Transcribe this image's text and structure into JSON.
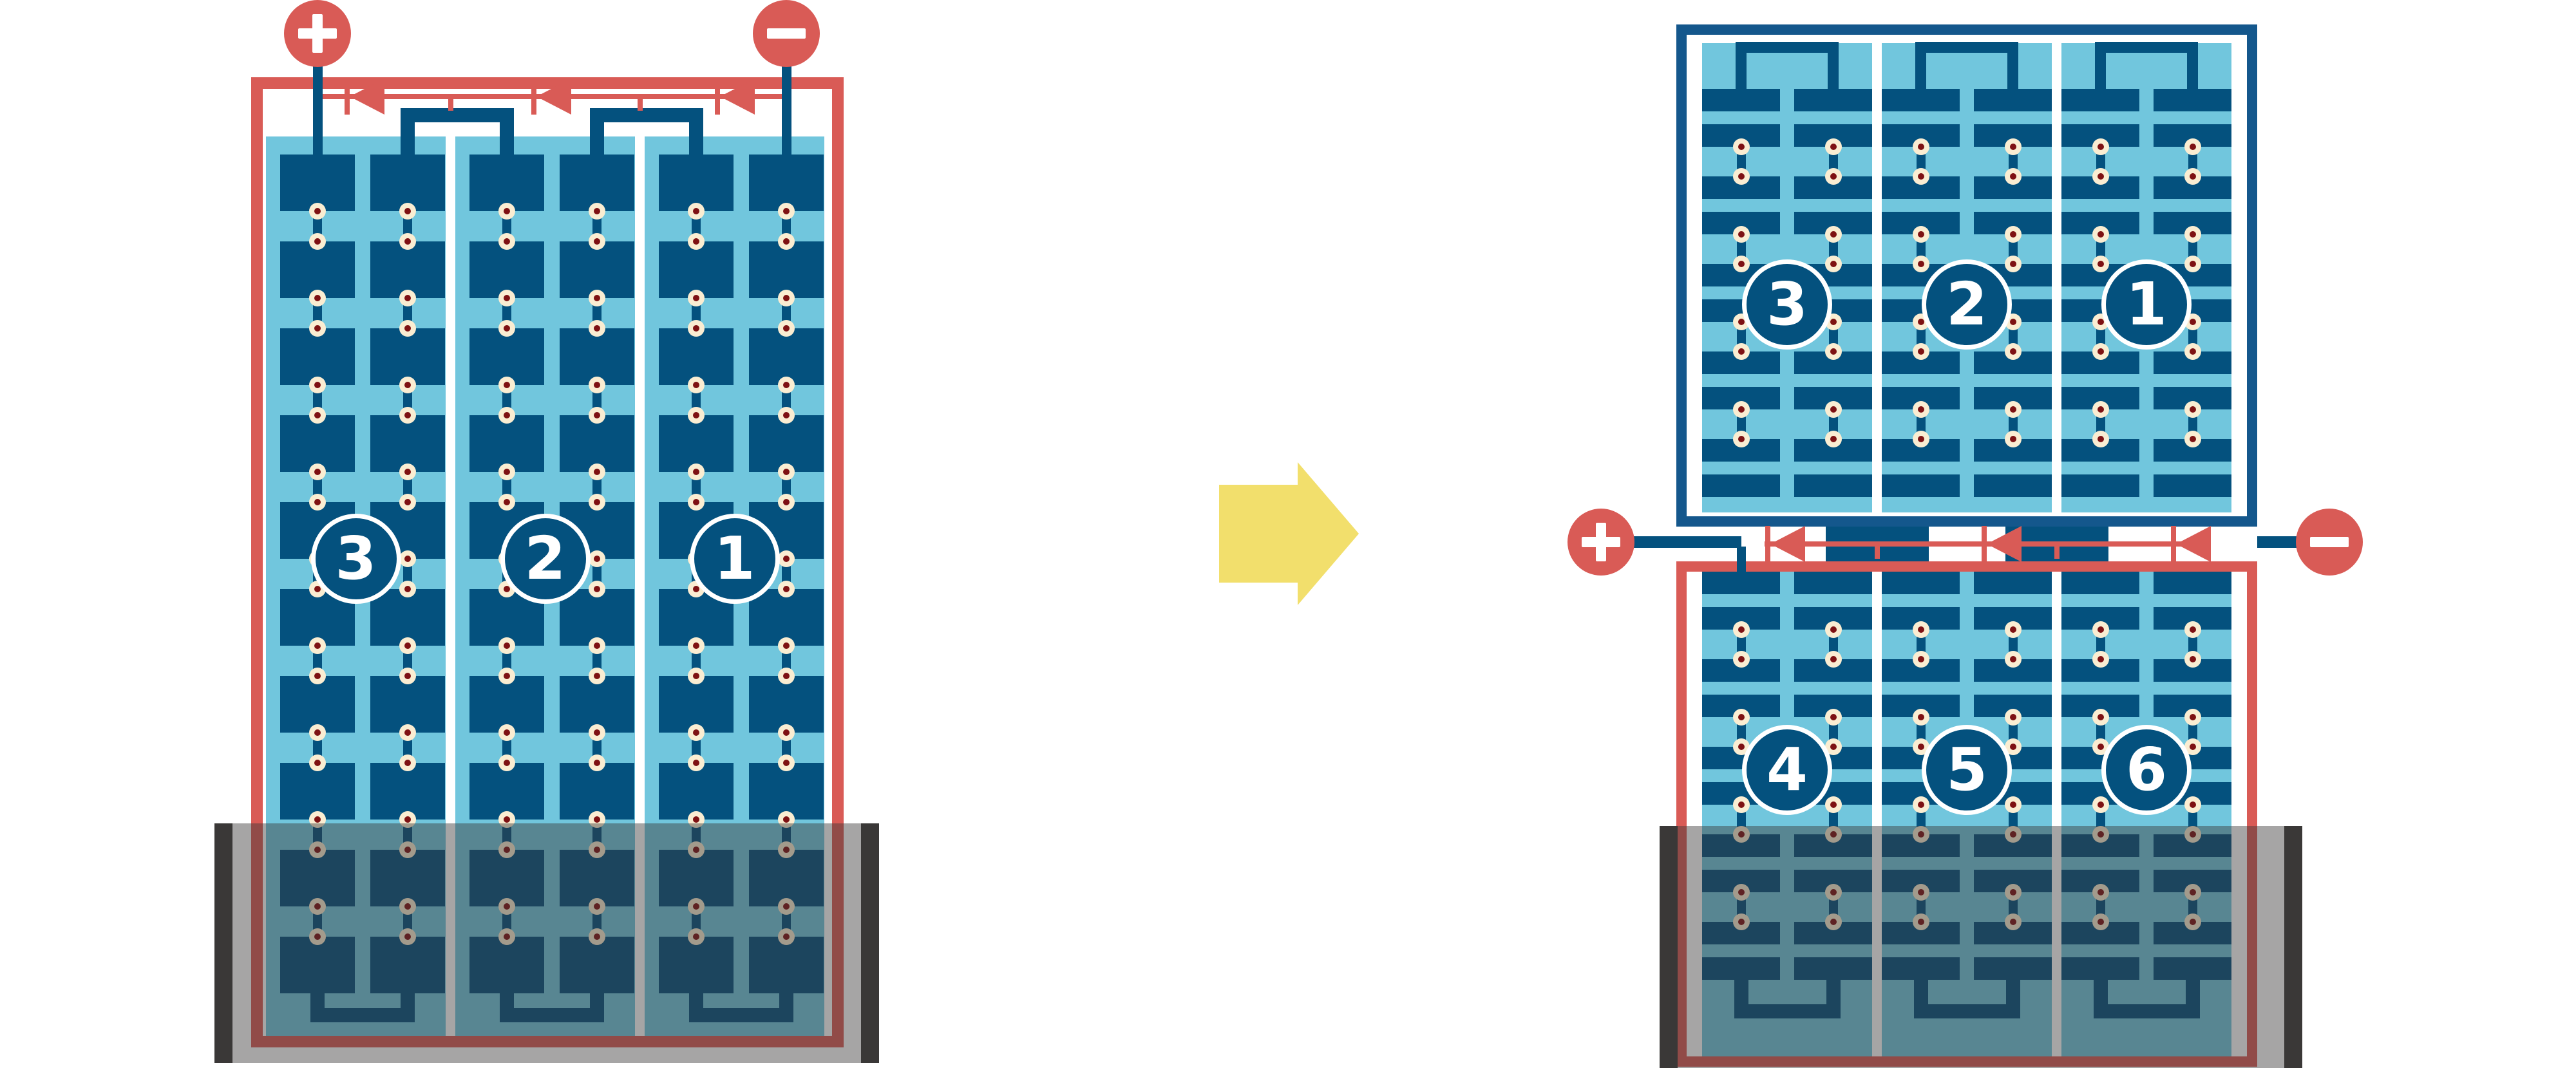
{
  "diagram_kind": "solar-module-string-wiring-comparison",
  "colors": {
    "cell_blue": "#04517E",
    "panel_light_blue": "#71C6DD",
    "frame_red": "#D95B56",
    "frame_blue": "#14578C",
    "circuit_red": "#D95B56",
    "solder_dot_cream": "#FAEDD2",
    "solder_dot_red": "#7E1113",
    "shade_bar_gray": "#3A3837",
    "shade_overlay": "rgba(58,56,55,0.45)",
    "arrow_yellow": "#F2DF6C",
    "separator_white": "#FFFFFF",
    "label_text": "#FFFFFF"
  },
  "left_module": {
    "kind": "full-cell module",
    "terminals": {
      "positive_symbol": "+",
      "negative_symbol": "−"
    },
    "bypass_diode_count": 3,
    "strings": [
      {
        "label": "3"
      },
      {
        "label": "2"
      },
      {
        "label": "1"
      }
    ],
    "columns_per_string": 2,
    "cell_rows": 10,
    "shaded_bottom": true
  },
  "right_module": {
    "kind": "half-cell module",
    "terminals": {
      "positive_symbol": "+",
      "negative_symbol": "−"
    },
    "bypass_diode_count": 3,
    "top_half": {
      "strings": [
        {
          "label": "3"
        },
        {
          "label": "2"
        },
        {
          "label": "1"
        }
      ],
      "cell_rows": 10
    },
    "bottom_half": {
      "strings": [
        {
          "label": "4"
        },
        {
          "label": "5"
        },
        {
          "label": "6"
        }
      ],
      "cell_rows": 10
    },
    "columns_per_string": 2,
    "shaded_bottom": true
  },
  "arrow": {
    "direction": "right",
    "meaning": "transforms-to"
  }
}
